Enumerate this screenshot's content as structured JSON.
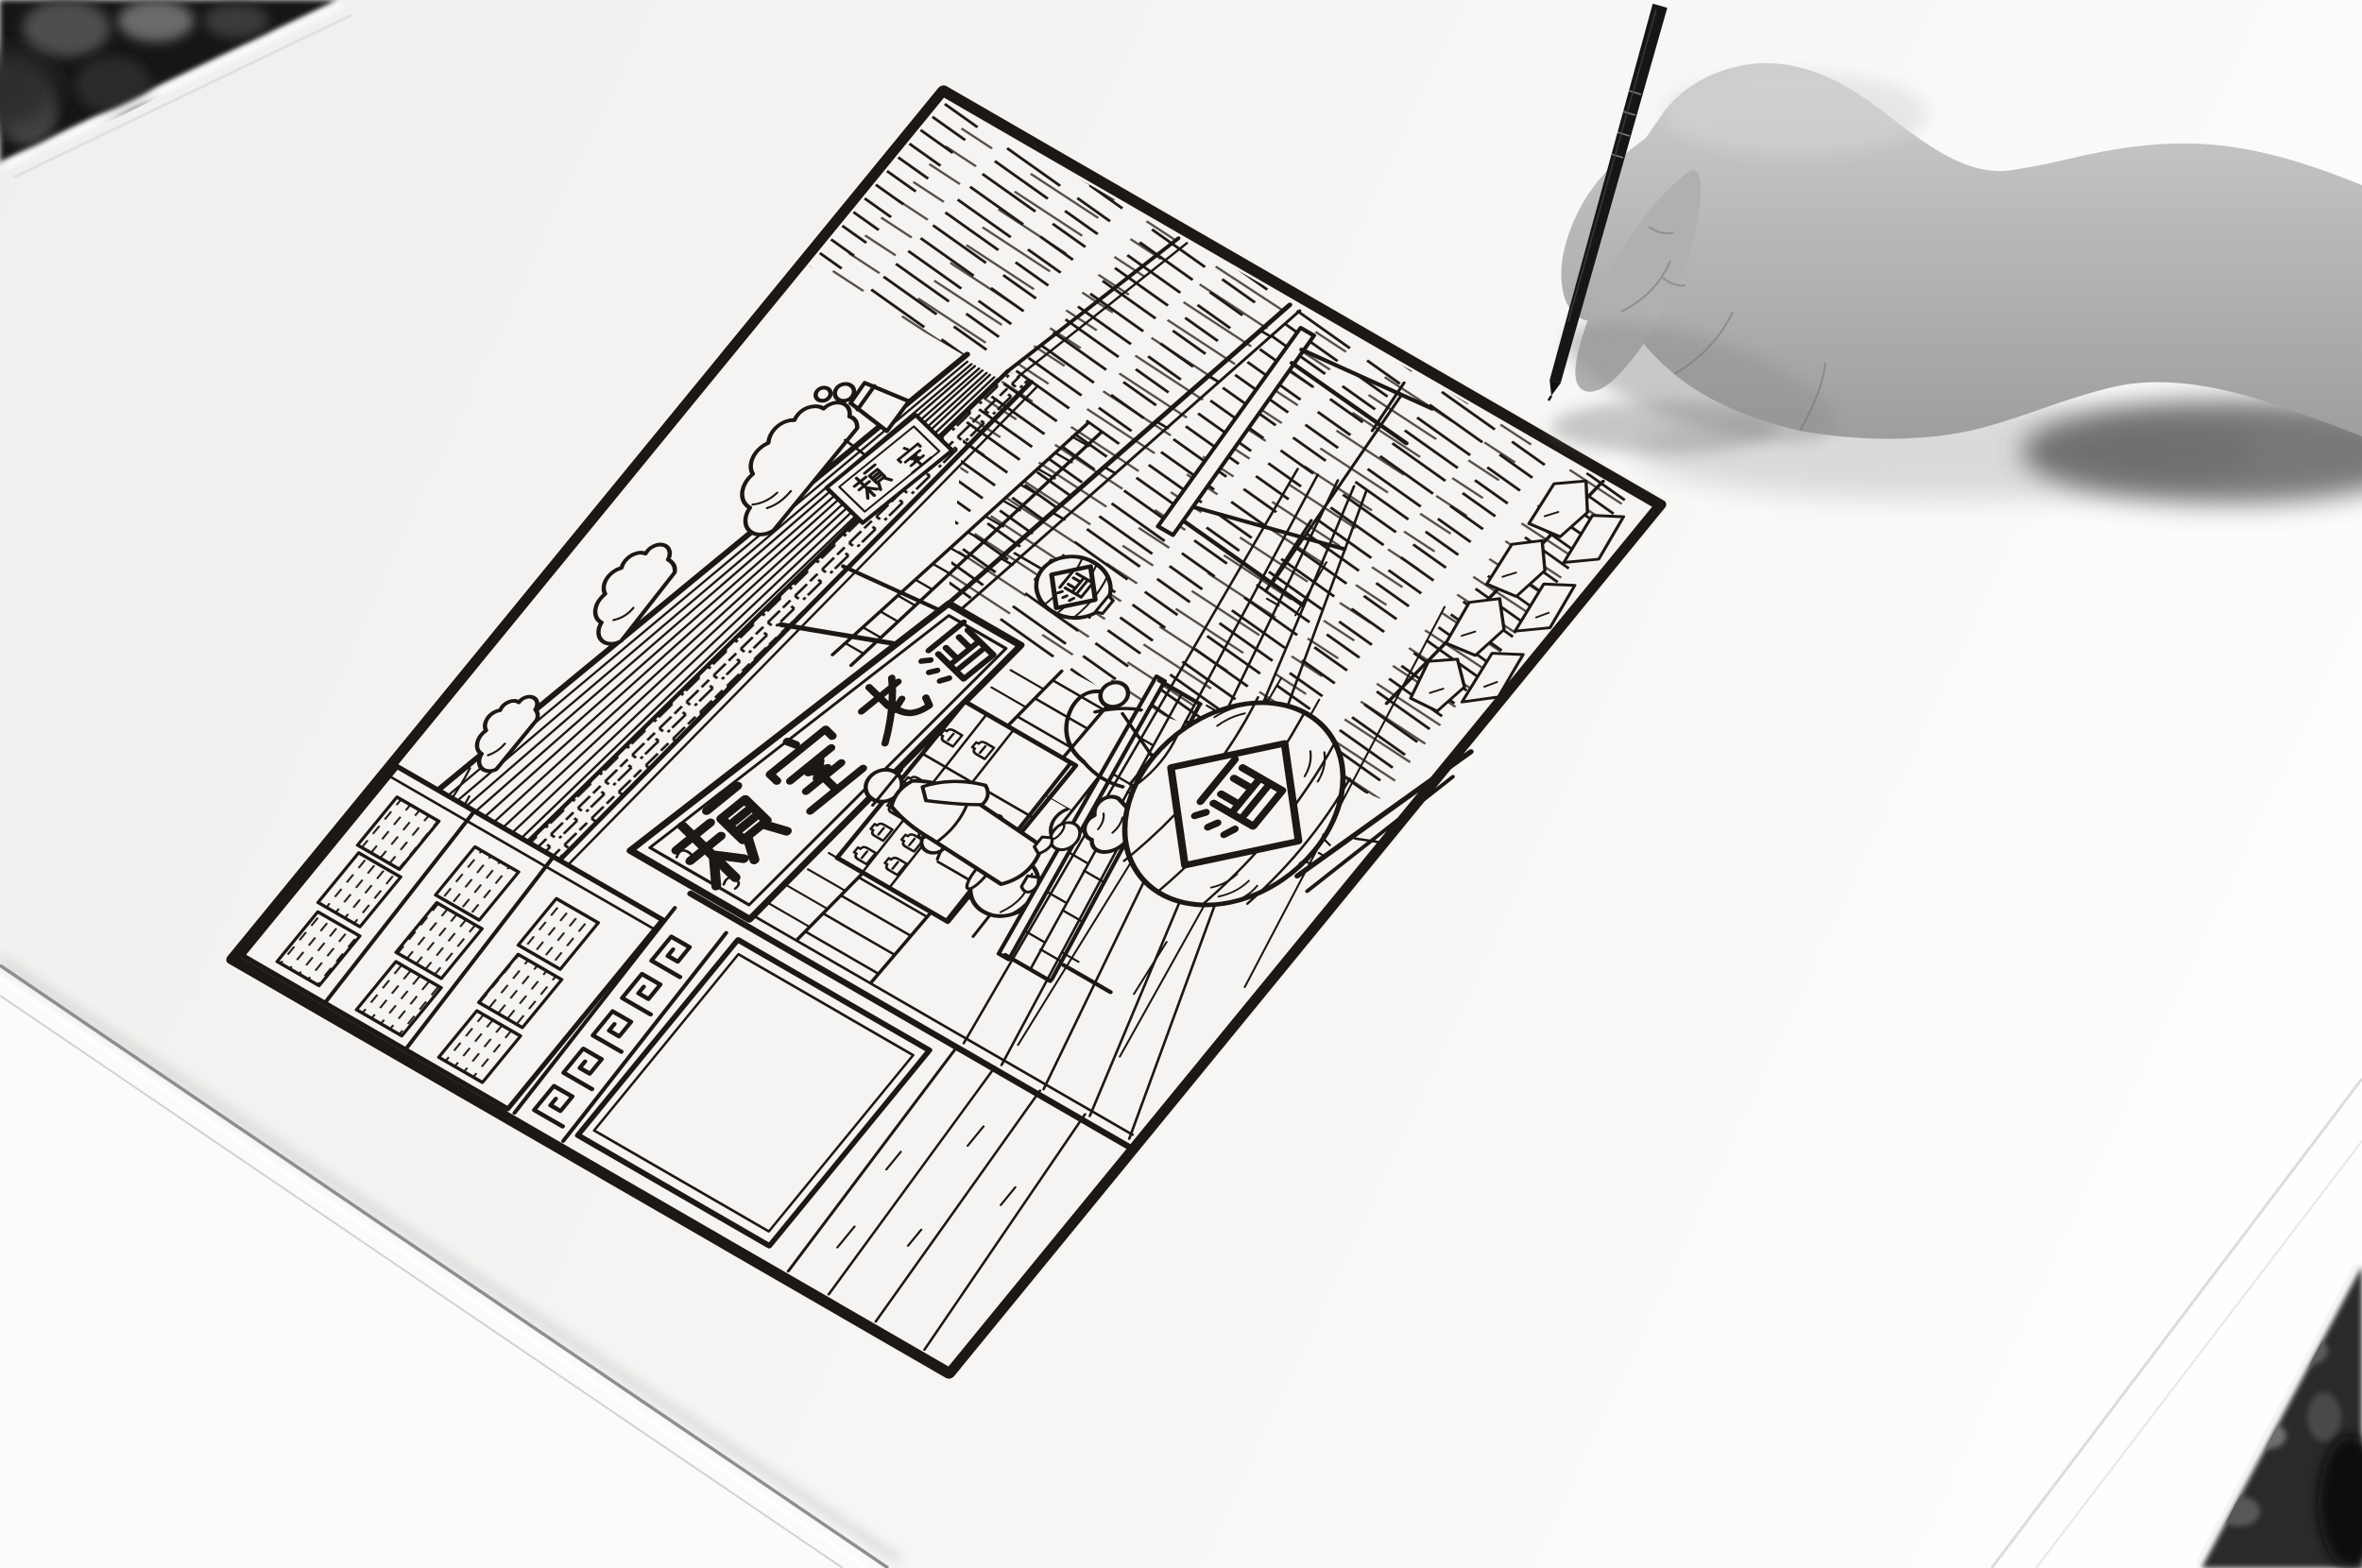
{
  "artwork": {
    "main_sign": {
      "text": "赖室老酒",
      "chars": [
        "赖",
        "室",
        "老",
        "酒"
      ]
    },
    "small_sign": {
      "text": "赖室",
      "chars": [
        "赖",
        "室"
      ]
    },
    "small_lantern": {
      "char": "酒"
    },
    "large_lantern": {
      "char": "酒"
    }
  },
  "colors": {
    "ink": "#1d1813",
    "paper": "#f5f4f2",
    "paper_bright": "#fdfdfd",
    "hand_skin_light": "#cdcdcd",
    "hand_skin_dark": "#9e9e9e",
    "pen_black": "#161616",
    "background_dark": "#181818"
  }
}
